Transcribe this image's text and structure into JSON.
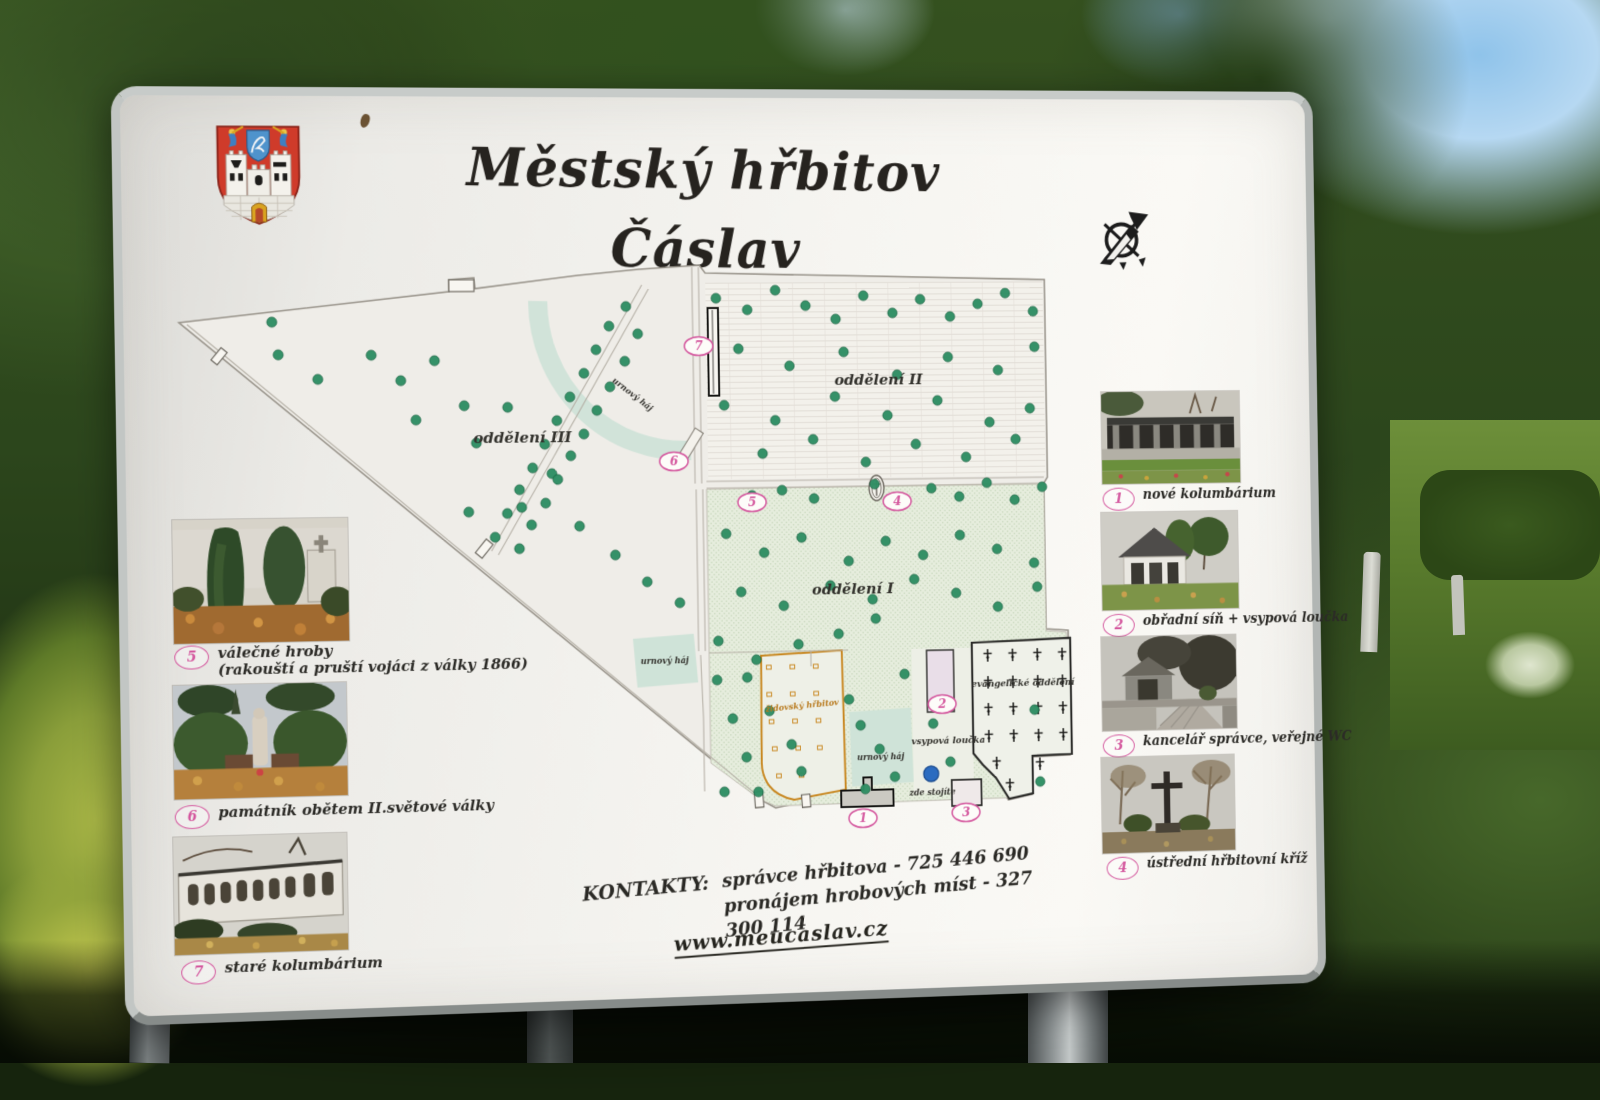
{
  "sign": {
    "title": "Městský hřbitov Čáslav",
    "contacts": {
      "label": "KONTAKTY:",
      "line1": "správce hřbitova - 725 446 690",
      "line2": "pronájem hrobových míst - 327 300 114",
      "website": "www.meucaslav.cz"
    }
  },
  "legend_left": [
    {
      "num": "5",
      "caption": "válečné hroby",
      "caption2": "(rakouští a pruští vojáci z války 1866)"
    },
    {
      "num": "6",
      "caption": "památník obětem II.světové války"
    },
    {
      "num": "7",
      "caption": "staré kolumbárium"
    }
  ],
  "legend_right": [
    {
      "num": "1",
      "caption": "nové kolumbárium"
    },
    {
      "num": "2",
      "caption": "obřadní síň + vsypová loučka"
    },
    {
      "num": "3",
      "caption": "kancelář správce, veřejné WC"
    },
    {
      "num": "4",
      "caption": "ústřední hřbitovní kříž"
    }
  ],
  "map": {
    "labels": {
      "oddeleni3": "oddělení III",
      "oddeleni2": "oddělení II",
      "oddeleni1": "oddělení I",
      "urnovy_haj_top": "urnový háj",
      "urnovy_haj_mid": "urnový háj",
      "urnovy_haj_low": "urnový háj",
      "zidovsky": "židovský hřbitov",
      "vsypova": "vsypová loučka",
      "evangelicke": "evangelické oddělení",
      "zde_stojite": "zde stojíte"
    },
    "colors": {
      "tree": "#2e8e63",
      "tree_edge": "#17603f",
      "marker": "#d4579e",
      "jewish": "#c8861e",
      "teal": "#cfe3d8",
      "paper": "#efede8",
      "green_area": "#e4ecdc",
      "you_are_here": "#2b6bc0"
    },
    "markers": [
      {
        "num": "1",
        "x": 713,
        "y": 578
      },
      {
        "num": "2",
        "x": 800,
        "y": 462
      },
      {
        "num": "3",
        "x": 824,
        "y": 575
      },
      {
        "num": "4",
        "x": 755,
        "y": 251
      },
      {
        "num": "5",
        "x": 600,
        "y": 250
      },
      {
        "num": "6",
        "x": 518,
        "y": 207
      },
      {
        "num": "7",
        "x": 546,
        "y": 89
      }
    ],
    "trees": [
      [
        110,
        95
      ],
      [
        150,
        120
      ],
      [
        104,
        62
      ],
      [
        235,
        122
      ],
      [
        270,
        102
      ],
      [
        345,
        150
      ],
      [
        312,
        186
      ],
      [
        390,
        218
      ],
      [
        358,
        252
      ],
      [
        303,
        256
      ],
      [
        418,
        272
      ],
      [
        455,
        302
      ],
      [
        488,
        330
      ],
      [
        300,
        148
      ],
      [
        205,
        96
      ],
      [
        250,
        162
      ],
      [
        522,
        352
      ],
      [
        470,
        48
      ],
      [
        452,
        68
      ],
      [
        482,
        76
      ],
      [
        438,
        92
      ],
      [
        468,
        104
      ],
      [
        425,
        116
      ],
      [
        452,
        130
      ],
      [
        410,
        140
      ],
      [
        438,
        154
      ],
      [
        396,
        164
      ],
      [
        424,
        178
      ],
      [
        383,
        188
      ],
      [
        410,
        200
      ],
      [
        370,
        212
      ],
      [
        396,
        224
      ],
      [
        356,
        234
      ],
      [
        383,
        248
      ],
      [
        343,
        258
      ],
      [
        368,
        270
      ],
      [
        330,
        282
      ],
      [
        355,
        294
      ],
      [
        565,
        40
      ],
      [
        598,
        52
      ],
      [
        628,
        32
      ],
      [
        660,
        48
      ],
      [
        692,
        62
      ],
      [
        722,
        38
      ],
      [
        753,
        56
      ],
      [
        783,
        42
      ],
      [
        815,
        60
      ],
      [
        845,
        47
      ],
      [
        875,
        36
      ],
      [
        905,
        55
      ],
      [
        588,
        92
      ],
      [
        642,
        110
      ],
      [
        700,
        96
      ],
      [
        757,
        120
      ],
      [
        812,
        102
      ],
      [
        866,
        116
      ],
      [
        906,
        92
      ],
      [
        572,
        150
      ],
      [
        626,
        166
      ],
      [
        690,
        142
      ],
      [
        746,
        162
      ],
      [
        800,
        147
      ],
      [
        856,
        170
      ],
      [
        900,
        156
      ],
      [
        612,
        200
      ],
      [
        666,
        186
      ],
      [
        722,
        210
      ],
      [
        776,
        192
      ],
      [
        830,
        206
      ],
      [
        884,
        188
      ],
      [
        600,
        243
      ],
      [
        632,
        238
      ],
      [
        666,
        247
      ],
      [
        731,
        233
      ],
      [
        762,
        251
      ],
      [
        792,
        238
      ],
      [
        822,
        247
      ],
      [
        852,
        233
      ],
      [
        882,
        251
      ],
      [
        912,
        238
      ],
      [
        572,
        282
      ],
      [
        612,
        302
      ],
      [
        652,
        287
      ],
      [
        702,
        312
      ],
      [
        742,
        292
      ],
      [
        782,
        307
      ],
      [
        822,
        287
      ],
      [
        862,
        302
      ],
      [
        902,
        317
      ],
      [
        587,
        342
      ],
      [
        632,
        357
      ],
      [
        682,
        337
      ],
      [
        727,
        352
      ],
      [
        772,
        332
      ],
      [
        817,
        347
      ],
      [
        862,
        362
      ],
      [
        905,
        342
      ],
      [
        562,
        392
      ],
      [
        602,
        412
      ],
      [
        647,
        397
      ],
      [
        690,
        387
      ],
      [
        730,
        372
      ],
      [
        560,
        432
      ],
      [
        576,
        472
      ],
      [
        590,
        512
      ],
      [
        566,
        547
      ],
      [
        592,
        430
      ],
      [
        615,
        465
      ],
      [
        638,
        500
      ],
      [
        648,
        528
      ],
      [
        602,
        548
      ],
      [
        700,
        455
      ],
      [
        712,
        482
      ],
      [
        732,
        507
      ],
      [
        748,
        536
      ],
      [
        716,
        548
      ],
      [
        790,
        482
      ],
      [
        808,
        522
      ],
      [
        900,
        470
      ],
      [
        905,
        545
      ],
      [
        760,
        430
      ]
    ],
    "crosses": [
      [
        850,
        413
      ],
      [
        877,
        413
      ],
      [
        904,
        413
      ],
      [
        931,
        413
      ],
      [
        850,
        441
      ],
      [
        877,
        441
      ],
      [
        904,
        441
      ],
      [
        931,
        441
      ],
      [
        850,
        469
      ],
      [
        877,
        469
      ],
      [
        904,
        469
      ],
      [
        931,
        469
      ],
      [
        850,
        497
      ],
      [
        877,
        497
      ],
      [
        904,
        497
      ],
      [
        931,
        497
      ],
      [
        858,
        525
      ],
      [
        905,
        527
      ],
      [
        872,
        548
      ]
    ],
    "jewish_graves": [
      [
        615,
        420
      ],
      [
        640,
        420
      ],
      [
        665,
        420
      ],
      [
        615,
        448
      ],
      [
        640,
        448
      ],
      [
        665,
        448
      ],
      [
        617,
        476
      ],
      [
        642,
        476
      ],
      [
        667,
        476
      ],
      [
        620,
        504
      ],
      [
        645,
        504
      ],
      [
        668,
        504
      ],
      [
        624,
        532
      ],
      [
        648,
        532
      ]
    ]
  }
}
